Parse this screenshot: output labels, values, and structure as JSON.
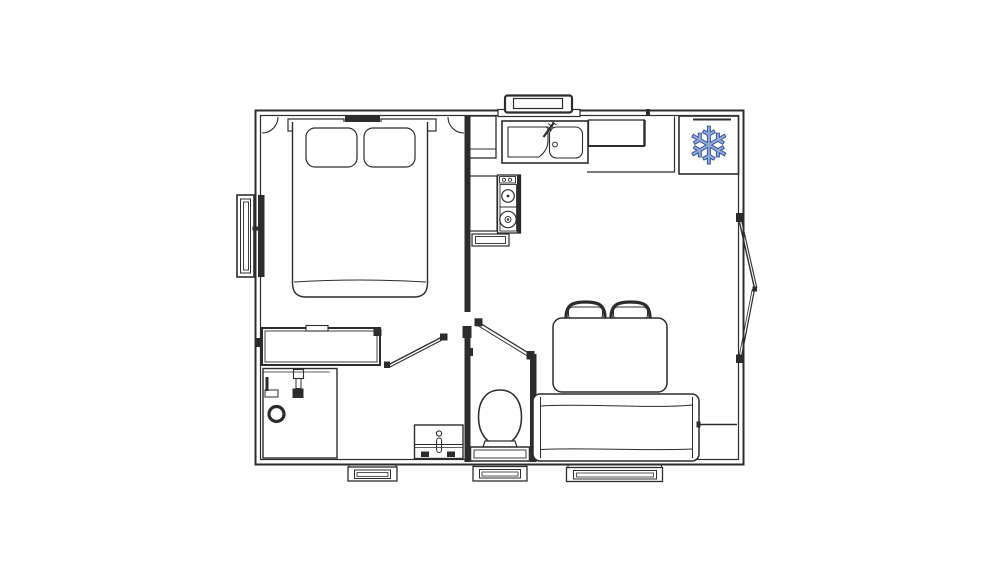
{
  "plan": {
    "background": "#ffffff",
    "line_color": "#2c2c2c",
    "wall_color": "#2c2c2c"
  },
  "icons": {
    "snowflake": "❄"
  },
  "colors": {
    "snowflake_fill": "#8fa8d6",
    "snowflake_stroke": "#2e4d95"
  }
}
